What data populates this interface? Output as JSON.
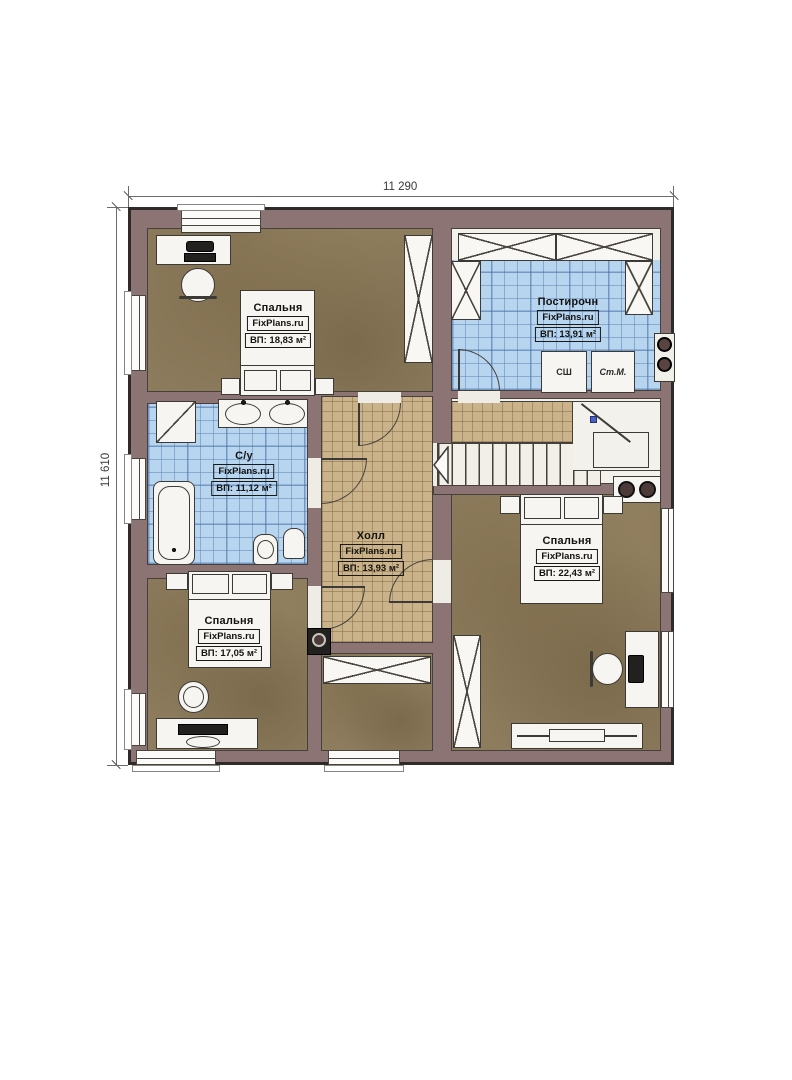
{
  "meta": {
    "type": "floor-plan",
    "brand": "FixPlans.ru"
  },
  "dimensions": {
    "top": "11 290",
    "left": "11 610"
  },
  "rooms": [
    {
      "id": "bedroom-top-left",
      "name": "Спальня",
      "brand": "FixPlans.ru",
      "area": "ВП: 18,83 м²"
    },
    {
      "id": "laundry",
      "name": "Постирочн",
      "brand": "FixPlans.ru",
      "area": "ВП: 13,91 м²"
    },
    {
      "id": "bathroom",
      "name": "С/у",
      "brand": "FixPlans.ru",
      "area": "ВП: 11,12 м²"
    },
    {
      "id": "hall",
      "name": "Холл",
      "brand": "FixPlans.ru",
      "area": "ВП: 13,93 м²"
    },
    {
      "id": "bedroom-right",
      "name": "Спальня",
      "brand": "FixPlans.ru",
      "area": "ВП: 22,43 м²"
    },
    {
      "id": "bedroom-bottom-left",
      "name": "Спальня",
      "brand": "FixPlans.ru",
      "area": "ВП: 17,05 м²"
    }
  ],
  "appliances": {
    "dryer_label": "СШ",
    "washer_label": "Ст.М."
  },
  "colors": {
    "wall": "#8d7474",
    "floor_wood": "#8d7c5d",
    "tile_blue": "#b7d5ef",
    "tile_tan": "#cab28a",
    "outline": "#3a3631",
    "stair_dot": "#4a5fc1"
  }
}
